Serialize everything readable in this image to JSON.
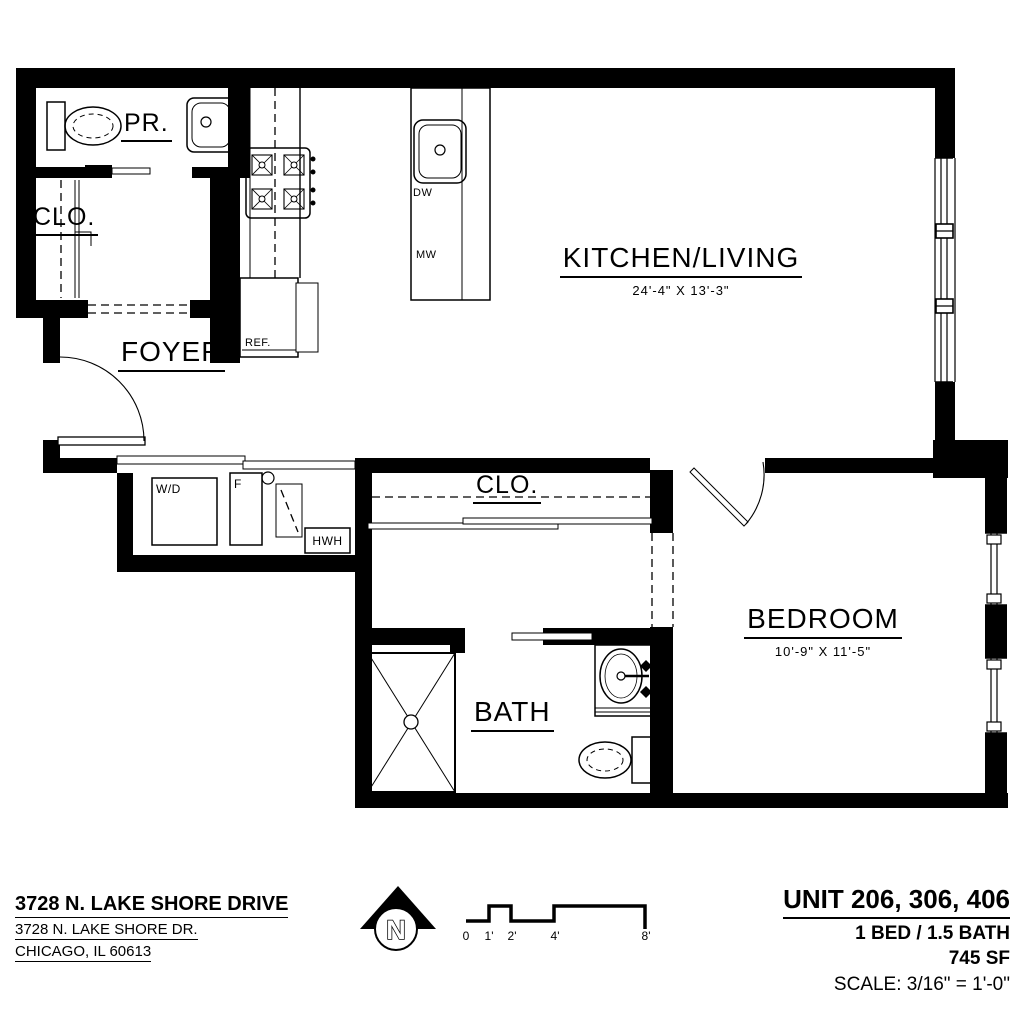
{
  "plan": {
    "rooms": {
      "powder": {
        "label": "PR."
      },
      "closet_upper": {
        "label": "CLO."
      },
      "foyer": {
        "label": "FOYER"
      },
      "kitchen_living": {
        "label": "KITCHEN/LIVING",
        "dims": "24'-4\" X 13'-3\""
      },
      "closet_hall": {
        "label": "CLO."
      },
      "bedroom": {
        "label": "BEDROOM",
        "dims": "10'-9\" X 11'-5\""
      },
      "bath": {
        "label": "BATH"
      }
    },
    "appliances": {
      "dishwasher": "DW",
      "microwave": "MW",
      "refrigerator": "REF.",
      "washer_dryer": "W/D",
      "furnace": "F",
      "water_heater": "HWH"
    }
  },
  "footer": {
    "address_title": "3728 N. LAKE SHORE DRIVE",
    "address_street": "3728 N. LAKE SHORE DR.",
    "address_city": "CHICAGO, IL 60613",
    "north_label": "N",
    "scale_bar_ticks": [
      "0",
      "1'",
      "2'",
      "4'",
      "8'"
    ],
    "unit_title": "UNIT 206, 306, 406",
    "unit_config": "1 BED / 1.5 BATH",
    "unit_area": "745 SF",
    "scale_note": "SCALE: 3/16\" = 1'-0\""
  },
  "colors": {
    "ink": "#000000",
    "paper": "#ffffff"
  }
}
